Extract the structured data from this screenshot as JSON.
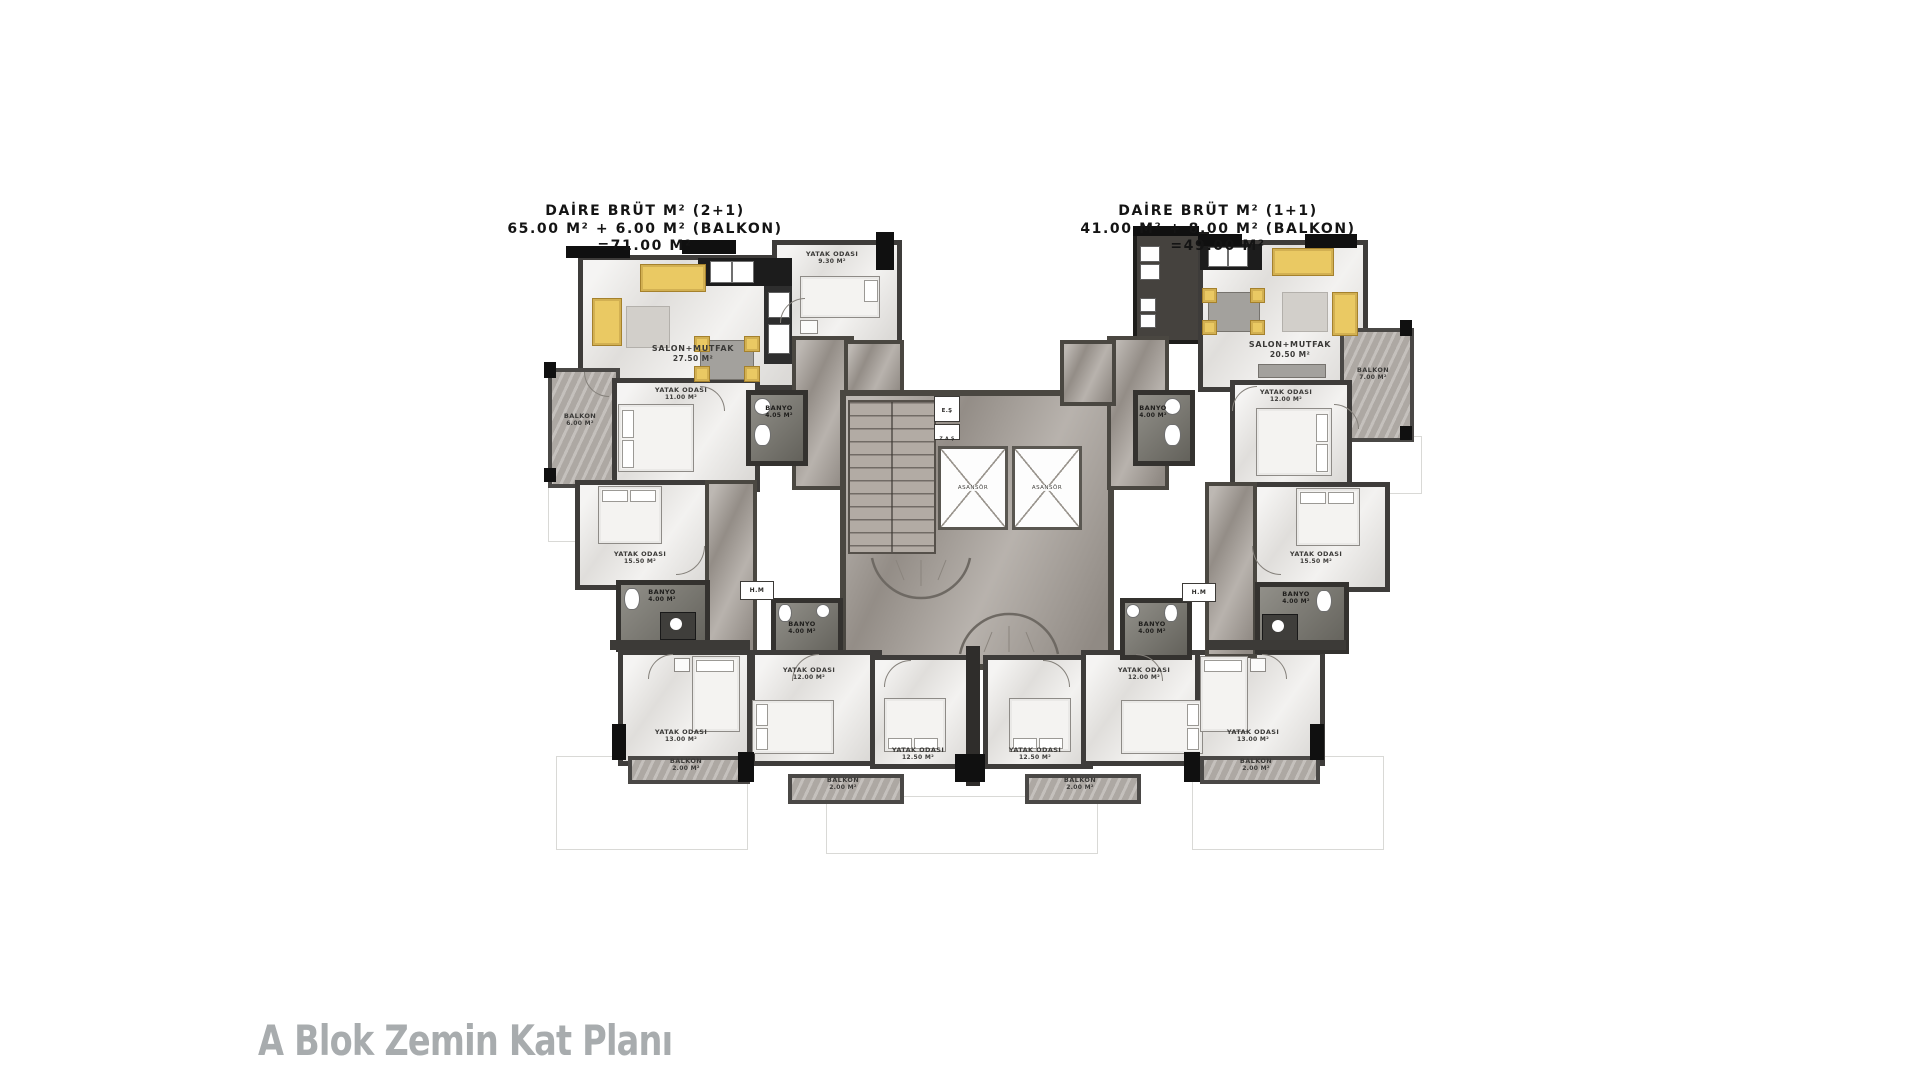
{
  "titles": {
    "left": {
      "line1": "DAİRE BRÜT M² (2+1)",
      "line2": "65.00 M² + 6.00 M² (BALKON)",
      "line3": "=71.00 M²"
    },
    "right": {
      "line1": "DAİRE BRÜT M² (1+1)",
      "line2": "41.00 M² + 8.00 M² (BALKON)",
      "line3": "=49.00 M²"
    }
  },
  "caption": "A Blok Zemin Kat Planı",
  "rooms": {
    "salon_left": {
      "name": "SALON+MUTFAK",
      "area": "27.50 M²"
    },
    "bed_top_left": {
      "name": "YATAK ODASI",
      "area": "9.30 M²"
    },
    "balkon_left": {
      "name": "BALKON",
      "area": "6.00 M²"
    },
    "bed_11_left": {
      "name": "YATAK ODASI",
      "area": "11.00 M²"
    },
    "banyo_top_left": {
      "name": "BANYO",
      "area": "4.05 M²"
    },
    "bed_15_left": {
      "name": "YATAK ODASI",
      "area": "15.50 M²"
    },
    "banyo_mid_left": {
      "name": "BANYO",
      "area": "4.00 M²"
    },
    "bed_13_left": {
      "name": "YATAK ODASI",
      "area": "13.00 M²"
    },
    "balkon_bottom_left": {
      "name": "BALKON",
      "area": "2.00 M²"
    },
    "banyo_bottom_left": {
      "name": "BANYO",
      "area": "4.00 M²"
    },
    "bed_12_bottom_left": {
      "name": "YATAK ODASI",
      "area": "12.00 M²"
    },
    "bed_125_bottom_left": {
      "name": "YATAK ODASI",
      "area": "12.50 M²"
    },
    "balkon_center_left": {
      "name": "BALKON",
      "area": "2.00 M²"
    },
    "bed_125_bottom_right": {
      "name": "YATAK ODASI",
      "area": "12.50 M²"
    },
    "bed_12_bottom_right": {
      "name": "YATAK ODASI",
      "area": "12.00 M²"
    },
    "banyo_bottom_right": {
      "name": "BANYO",
      "area": "4.00 M²"
    },
    "balkon_center_right": {
      "name": "BALKON",
      "area": "2.00 M²"
    },
    "bed_13_right": {
      "name": "YATAK ODASI",
      "area": "13.00 M²"
    },
    "balkon_bottom_right": {
      "name": "BALKON",
      "area": "2.00 M²"
    },
    "salon_right": {
      "name": "SALON+MUTFAK",
      "area": "20.50 M²"
    },
    "balkon_right": {
      "name": "BALKON",
      "area": "7.00 M²"
    },
    "bed_12_right": {
      "name": "YATAK ODASI",
      "area": "12.00 M²"
    },
    "banyo_top_right": {
      "name": "BANYO",
      "area": "4.00 M²"
    },
    "bed_15_right": {
      "name": "YATAK ODASI",
      "area": "15.50 M²"
    },
    "banyo_mid_right": {
      "name": "BANYO",
      "area": "4.00 M²"
    }
  },
  "core": {
    "elevator": "ASANSÖR",
    "shaft_e": "E.Ş",
    "shaft_za": "Z.A.Ş",
    "hm": "H.M"
  },
  "colors": {
    "furniture_accent": "#eac963",
    "wall": "#3c3a37",
    "corridor_floor": "#a49d96",
    "room_floor": "#e9e7e4",
    "bath_floor": "#79776f",
    "caption_gray": "#a8acae"
  }
}
